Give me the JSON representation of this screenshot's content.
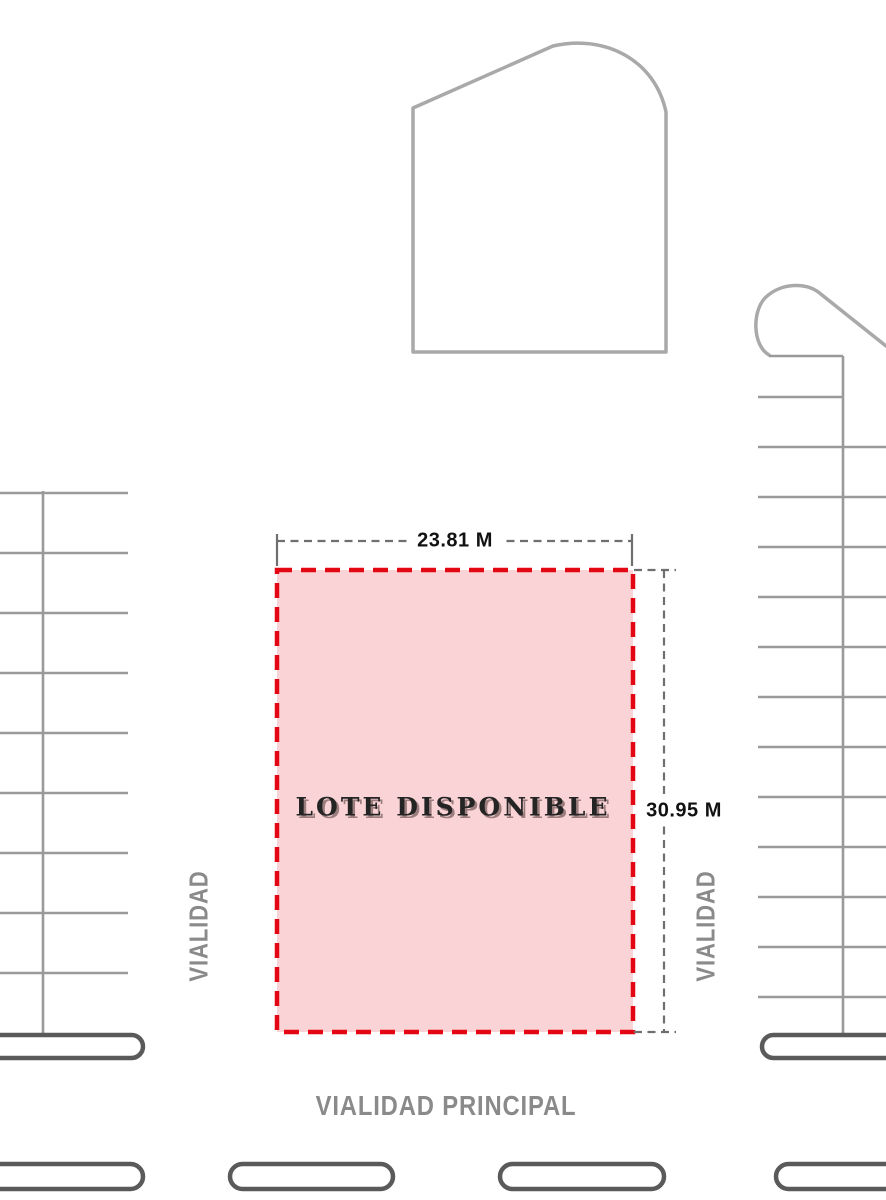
{
  "site_plan": {
    "lot": {
      "label": "LOTE DISPONIBLE",
      "width_label": "23.81 M",
      "height_label": "30.95 M"
    },
    "roads": {
      "left": "VIALIDAD",
      "right": "VIALIDAD",
      "bottom": "VIALIDAD PRINCIPAL"
    }
  },
  "colors": {
    "lot-fill": "#F9D3D5",
    "lot-stroke": "#E30613",
    "outline-gray": "#A9A9A9",
    "line-gray": "#9A9A9A",
    "curb-gray": "#5A5A5A",
    "dim-gray": "#6F6F6F",
    "label-gray": "#8A8A8A",
    "text-dark": "#111111"
  }
}
